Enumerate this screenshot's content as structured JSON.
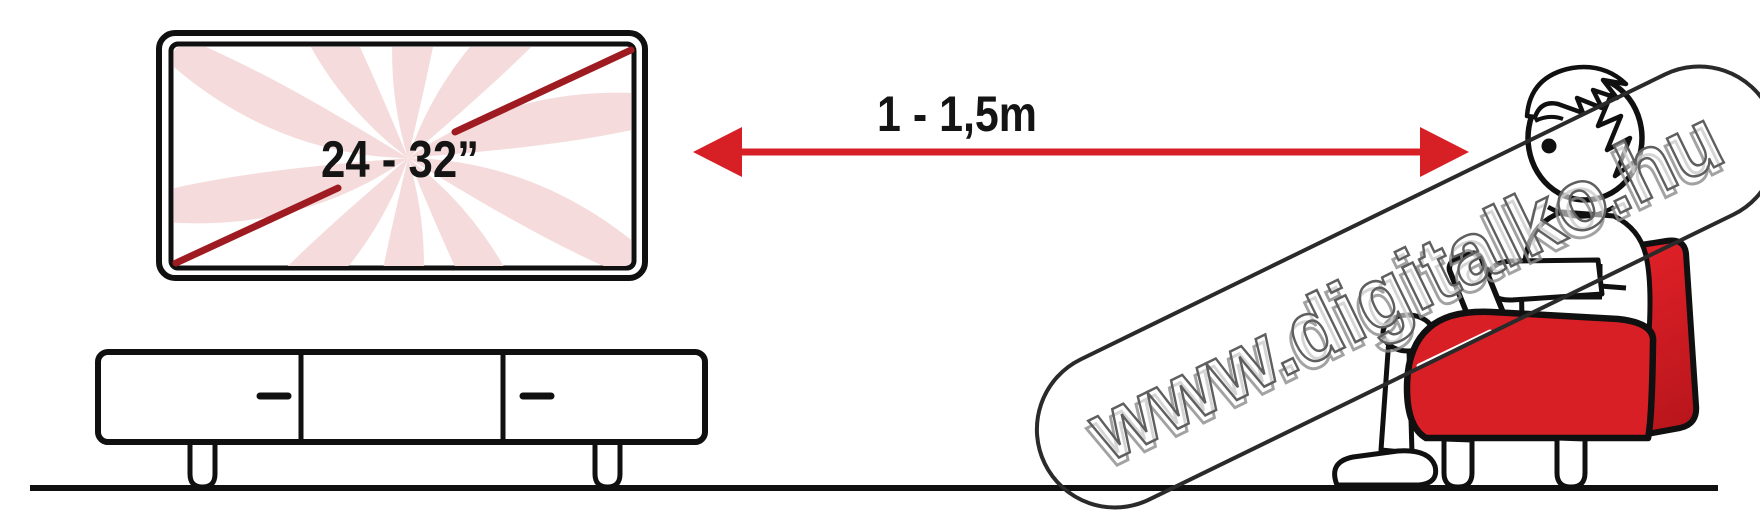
{
  "illustration": {
    "title_hint": "TV viewing distance diagram",
    "tv": {
      "size_label": "24 - 32”"
    },
    "distance": {
      "label": "1 - 1,5m"
    },
    "watermark": {
      "text": "www.digitalko.hu"
    },
    "colors": {
      "accent_red": "#d71f26",
      "diagonal_dark_red": "#9e1c21",
      "screen_swirl_pink": "#f5dbdb",
      "outline_black": "#101010",
      "watermark_gray": "#8c8c8c"
    }
  }
}
